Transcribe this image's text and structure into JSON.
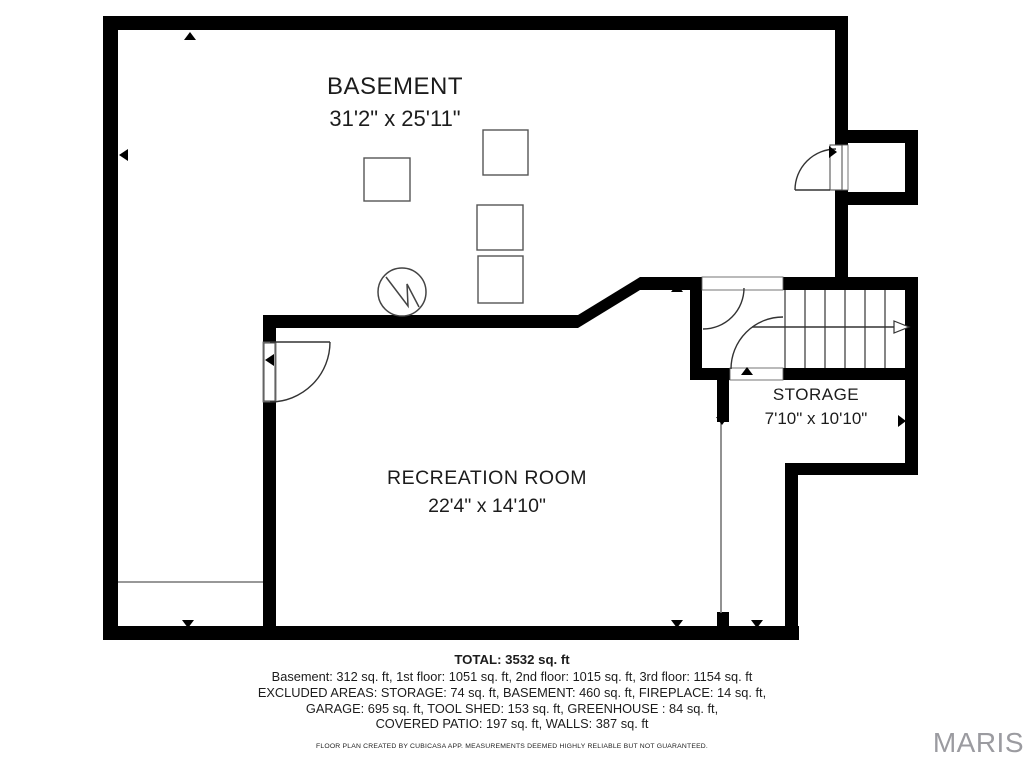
{
  "floorplan": {
    "rooms": [
      {
        "name": "BASEMENT",
        "dims": "31'2\" x 25'11\""
      },
      {
        "name": "RECREATION ROOM",
        "dims": "22'4\" x 14'10\""
      },
      {
        "name": "STORAGE",
        "dims": "7'10\" x 10'10\""
      }
    ],
    "icons": {
      "fireplace": "fireplace-icon",
      "door_swing": "door-swing-arc",
      "stairs": "staircase-with-direction-arrow",
      "furniture": "furniture-box",
      "markers": "direction-marker-triangles"
    },
    "colors": {
      "wall": "#000000",
      "background": "#ffffff",
      "symbol_stroke": "#444444"
    }
  },
  "summary": {
    "total": "TOTAL: 3532 sq. ft",
    "floors": "Basement: 312 sq. ft, 1st floor: 1051 sq. ft, 2nd floor: 1015 sq. ft, 3rd floor: 1154 sq. ft",
    "excluded_line1": "EXCLUDED AREAS: STORAGE: 74 sq. ft, BASEMENT: 460 sq. ft, FIREPLACE: 14 sq. ft,",
    "excluded_line2": "GARAGE: 695 sq. ft, TOOL SHED: 153 sq. ft, GREENHOUSE : 84 sq. ft,",
    "excluded_line3": "COVERED PATIO: 197 sq. ft, WALLS: 387 sq. ft",
    "disclaimer": "FLOOR PLAN CREATED BY CUBICASA APP. MEASUREMENTS DEEMED HIGHLY RELIABLE BUT NOT GUARANTEED."
  },
  "branding": {
    "logo_text": "MARIS",
    "logo_color": "#9b9ba0"
  }
}
